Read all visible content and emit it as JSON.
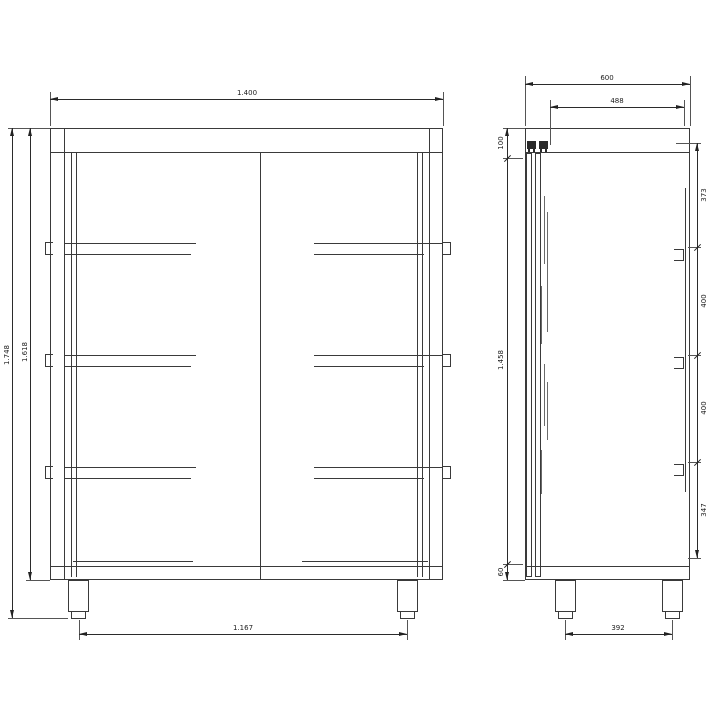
{
  "front_view": {
    "width": "1.400",
    "total_height": "1.748",
    "body_height": "1.618",
    "feet_span": "1.167"
  },
  "side_view": {
    "depth": "600",
    "inner_depth": "488",
    "top_section_height": "100",
    "door_height": "1.458",
    "base_height": "60",
    "feet_span": "392",
    "bay_heights": [
      "373",
      "400",
      "400",
      "347"
    ]
  },
  "colors": {
    "background": "#ffffff",
    "line": "#3a3a3a",
    "text": "#1c1c1c"
  }
}
